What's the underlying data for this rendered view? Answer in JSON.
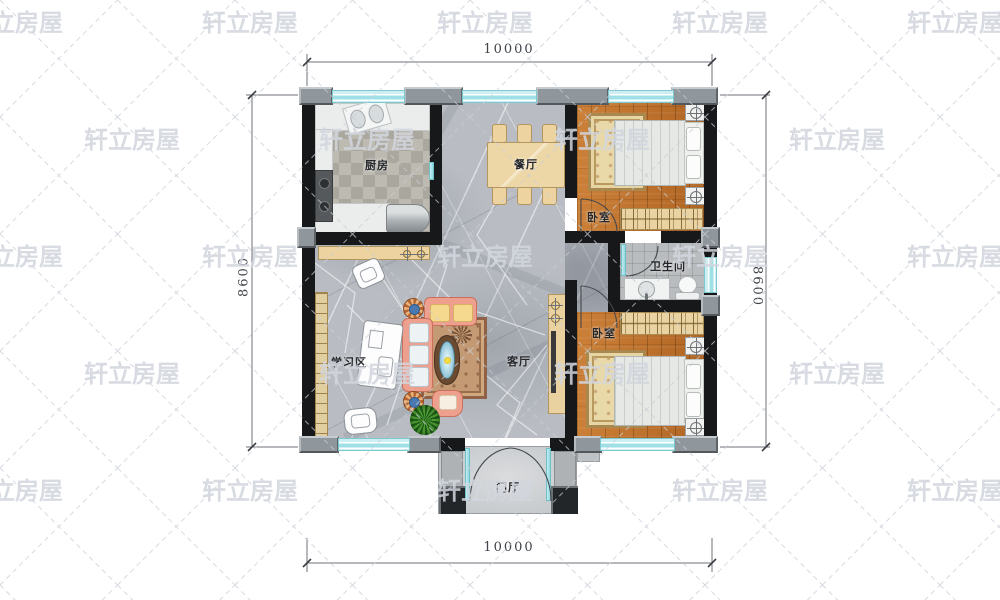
{
  "watermark": {
    "text": "轩立房屋"
  },
  "dimensions": {
    "top": "10000",
    "bottom": "10000",
    "left": "8600",
    "right": "8600"
  },
  "rooms": {
    "kitchen": {
      "label": "厨房"
    },
    "dining": {
      "label": "餐厅"
    },
    "bedroom1": {
      "label": "卧室"
    },
    "bathroom": {
      "label": "卫生间"
    },
    "living": {
      "label": "客厅"
    },
    "study": {
      "label": "学习区"
    },
    "bedroom2": {
      "label": "卧室"
    },
    "entry": {
      "label": "门厅"
    }
  },
  "colors": {
    "wall": "#17181a",
    "window_glass": "#bfe9ee",
    "wood_floor": "#c06f28",
    "marble_floor": "#b9bdc3",
    "furniture_tan": "#ecd3a0",
    "sofa_coral": "#eda08d",
    "rug_cream": "#ead9a8",
    "plant_green": "#4e9a34",
    "watermark_gray": "#ccd1d9"
  }
}
